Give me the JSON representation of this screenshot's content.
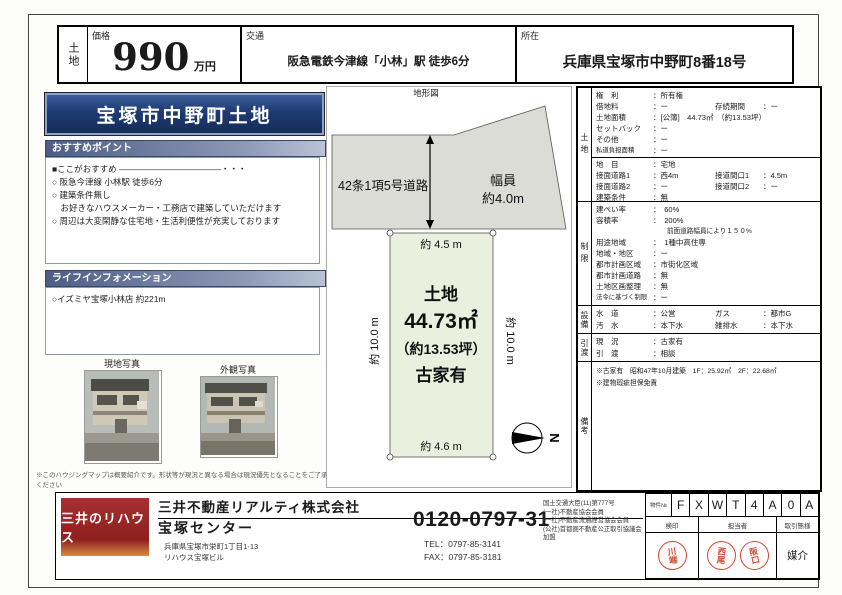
{
  "colors": {
    "banner_navy": "#1d3b72",
    "section_bar_blue": "#4e5d85",
    "road_gray": "#dcdcd6",
    "parcel_green": "#eaf0de",
    "logo_red": "#8e2020",
    "stamp_red": "#cc4a33"
  },
  "header": {
    "type_vertical": "土地",
    "price_label": "価格",
    "price_value": "990",
    "price_unit": "万円",
    "access_label": "交通",
    "access_value": "阪急電鉄今津線「小林」駅 徒歩6分",
    "location_label": "所在",
    "location_value": "兵庫県宝塚市中野町8番18号"
  },
  "left": {
    "title": "宝塚市中野町土地",
    "recommend_header": "おすすめポイント",
    "recommend_intro": "■ここがおすすめ ――――――――――――・・・",
    "recommend_points": [
      "○ 阪急今津線 小林駅 徒歩6分",
      "○ 建築条件無し",
      "　お好きなハウスメーカー・工務店で建築していただけます",
      "○ 周辺は大変閑静な住宅地・生活利便性が充実しております"
    ],
    "life_header": "ライフインフォメーション",
    "life_items": [
      "○イズミヤ宝塚小林店 約221m"
    ],
    "photo1_label": "現地写真",
    "photo2_label": "外観写真",
    "disclaimer": "※このハウジングマップは概要紹介です。形状等が現況と異なる場合は現況優先となることをご了承ください"
  },
  "diagram": {
    "title": "地形図",
    "road_label": "42条1項5号道路",
    "width_label": "幅員",
    "width_value": "約4.0m",
    "dim_top": "約 4.5 m",
    "dim_left": "約 10.0 m",
    "dim_right": "約 10.0 m",
    "dim_bottom": "約 4.6 m",
    "parcel_line1": "土地",
    "parcel_line2": "44.73㎡",
    "parcel_line3": "（約13.53坪）",
    "parcel_line4": "古家有",
    "compass_n": "N"
  },
  "details": {
    "sections": [
      {
        "side": "土地",
        "rows": [
          {
            "l": "権　利",
            "v": "：所有権"
          },
          {
            "l": "借地料",
            "v": "：ー",
            "l2": "存続期間",
            "v2": "：ー"
          },
          {
            "l": "土地面積",
            "v": "：[公簿]　44.73㎡　（約13.53坪）"
          },
          {
            "l": "セットバック",
            "v": "：ー"
          },
          {
            "l": "その他",
            "v": "：ー"
          },
          {
            "l": "私道負担面積",
            "v": "：ー"
          },
          {
            "l": "地　目",
            "v": "：宅地"
          },
          {
            "l": "接面道路1",
            "v": "：西4m",
            "l2": "接道間口1",
            "v2": "：4.5m"
          },
          {
            "l": "接面道路2",
            "v": "：ー",
            "l2": "接道間口2",
            "v2": "：ー"
          },
          {
            "l": "建築条件",
            "v": "：無"
          }
        ]
      },
      {
        "side": "制限",
        "rows": [
          {
            "l": "建ぺい率",
            "v": "：　60%"
          },
          {
            "l": "容積率",
            "v": "：　200%"
          },
          {
            "l": "",
            "v": "前面道路幅員により１５０%"
          },
          {
            "l": "用途地域",
            "v": "：　1種中高住専"
          },
          {
            "l": "地域・地区",
            "v": "：ー"
          },
          {
            "l": "都市計画区域",
            "v": "：市街化区域"
          },
          {
            "l": "都市計画道路",
            "v": "：無"
          },
          {
            "l": "土地区画整理",
            "v": "：無"
          },
          {
            "l": "法令に基づく制限",
            "v": "：ー"
          }
        ]
      },
      {
        "side": "設備",
        "rows": [
          {
            "l": "水　道",
            "v": "：公営",
            "l2": "ガス",
            "v2": "：都市G"
          },
          {
            "l": "汚　水",
            "v": "：本下水",
            "l2": "雑排水",
            "v2": "：本下水"
          }
        ]
      },
      {
        "side": "引渡",
        "rows": [
          {
            "l": "現　況",
            "v": "：古家有"
          },
          {
            "l": "引　渡",
            "v": "：相談"
          }
        ]
      },
      {
        "side": "備考",
        "rows": [
          {
            "l": "",
            "v": "※古家有　昭和47年10月建築　1F：25.92㎡　2F：22.68㎡"
          },
          {
            "l": "",
            "v": "※建物瑕疵担保免責"
          }
        ]
      }
    ]
  },
  "footer": {
    "logo": "三井のリハウス",
    "company": "三井不動産リアルティ株式会社",
    "office": "宝塚センター",
    "address1": "兵庫県宝塚市栄町1丁目1-13",
    "address2": "リハウス宝塚ビル",
    "phone": "0120-0797-31",
    "tel": "TEL：0797-85-3141",
    "fax": "FAX：0797-85-3181",
    "licenses": [
      "国土交通大臣(11)第777号",
      "(一社)不動産協会会員",
      "(一社)不動産流通経営協会会員",
      "(公社)首都圏不動産公正取引協議会加盟"
    ],
    "code_label": "物件№",
    "code_chars": [
      "F",
      "X",
      "W",
      "T",
      "4",
      "A",
      "0",
      "A"
    ],
    "stamp_header_1": "検印",
    "stamp_header_2": "担当者",
    "stamp_header_3": "取引態様",
    "stamps": [
      "川端",
      "西尾",
      "阪口"
    ],
    "transaction_type": "媒介"
  }
}
